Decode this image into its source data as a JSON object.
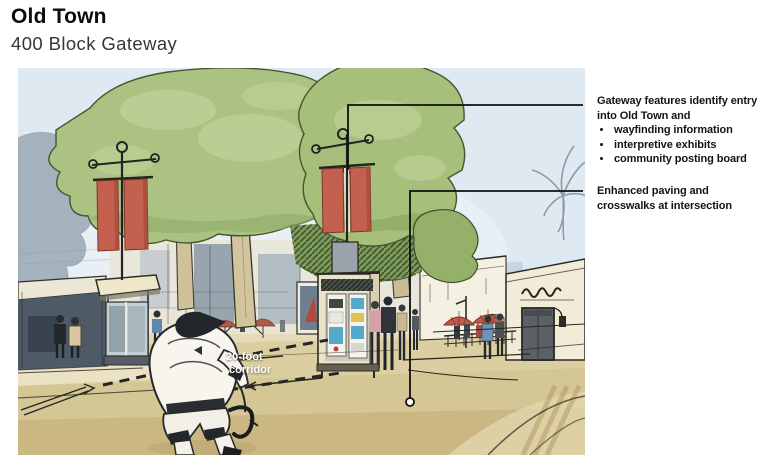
{
  "slide": {
    "title": "Old Town",
    "subtitle": "400 Block Gateway"
  },
  "annotations": {
    "gateway": {
      "heading": "Gateway features identify entry into Old Town and",
      "bullets": [
        "wayfinding information",
        "interpretive exhibits",
        "community posting board"
      ]
    },
    "paving": {
      "text": "Enhanced paving and crosswalks at intersection"
    }
  },
  "sketch": {
    "description": "Hand-drawn watercolor rendering of the 400 block gateway: tree-lined street with red gateway banners, information kiosks, storefronts, cafe umbrellas and a cyclist crossing the intersection",
    "corridor_label": {
      "line1": "20-foot",
      "line2": "corridor"
    },
    "colors": {
      "sky_blue": "#dfe9f1",
      "tree_green": "#abc282",
      "banner_red": "#c4604e",
      "road_tan": "#dbcfa2",
      "umbrella_red": "#c05a4a",
      "ink": "#26292b"
    }
  }
}
